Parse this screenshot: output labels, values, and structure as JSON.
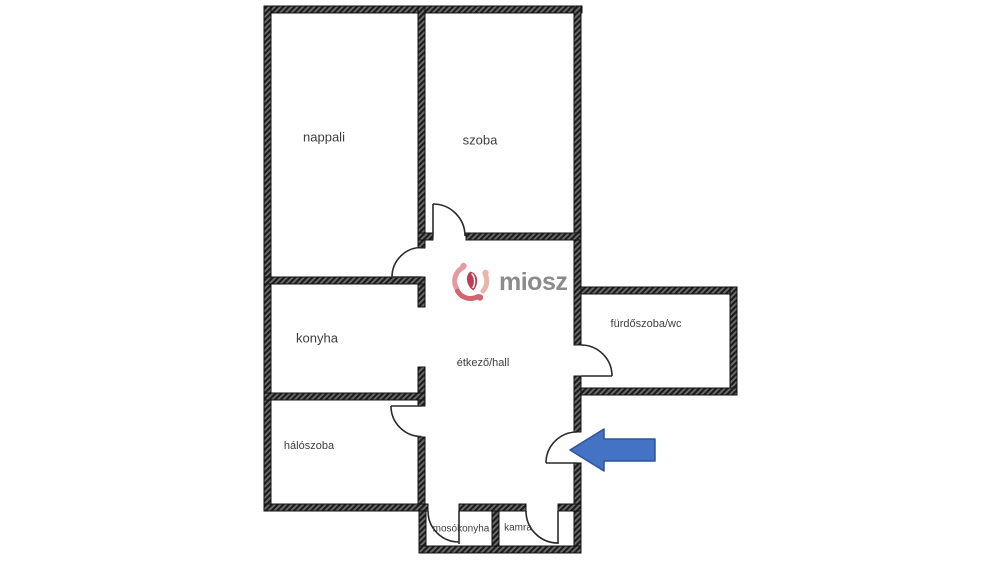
{
  "floorplan": {
    "type": "apartment-floor-plan",
    "rooms": {
      "nappali": {
        "label": "nappali"
      },
      "szoba": {
        "label": "szoba"
      },
      "konyha": {
        "label": "konyha"
      },
      "etkezo": {
        "label": "étkező/hall"
      },
      "furdoszoba": {
        "label": "fürdőszoba/wc"
      },
      "haloszoba": {
        "label": "hálószoba"
      },
      "mosokonyha": {
        "label": "mosókonyha"
      },
      "kamra": {
        "label": "kamra"
      }
    },
    "annotations": {
      "entrance_arrow": {
        "direction": "left",
        "fill_color": "#4472c4",
        "border_color": "#2f5597"
      }
    },
    "colors": {
      "wall": "#1c1c1c",
      "wall_hatch": "#6e6e6e",
      "door_line": "#2a2a2a",
      "background": "#ffffff",
      "label_text": "#3d3d3d"
    }
  },
  "watermark": {
    "brand": "miosz",
    "text_color": "#8b8b8b",
    "logo_colors": [
      "#e59aa0",
      "#d4646d",
      "#eab4ab",
      "#bf3d54"
    ]
  }
}
